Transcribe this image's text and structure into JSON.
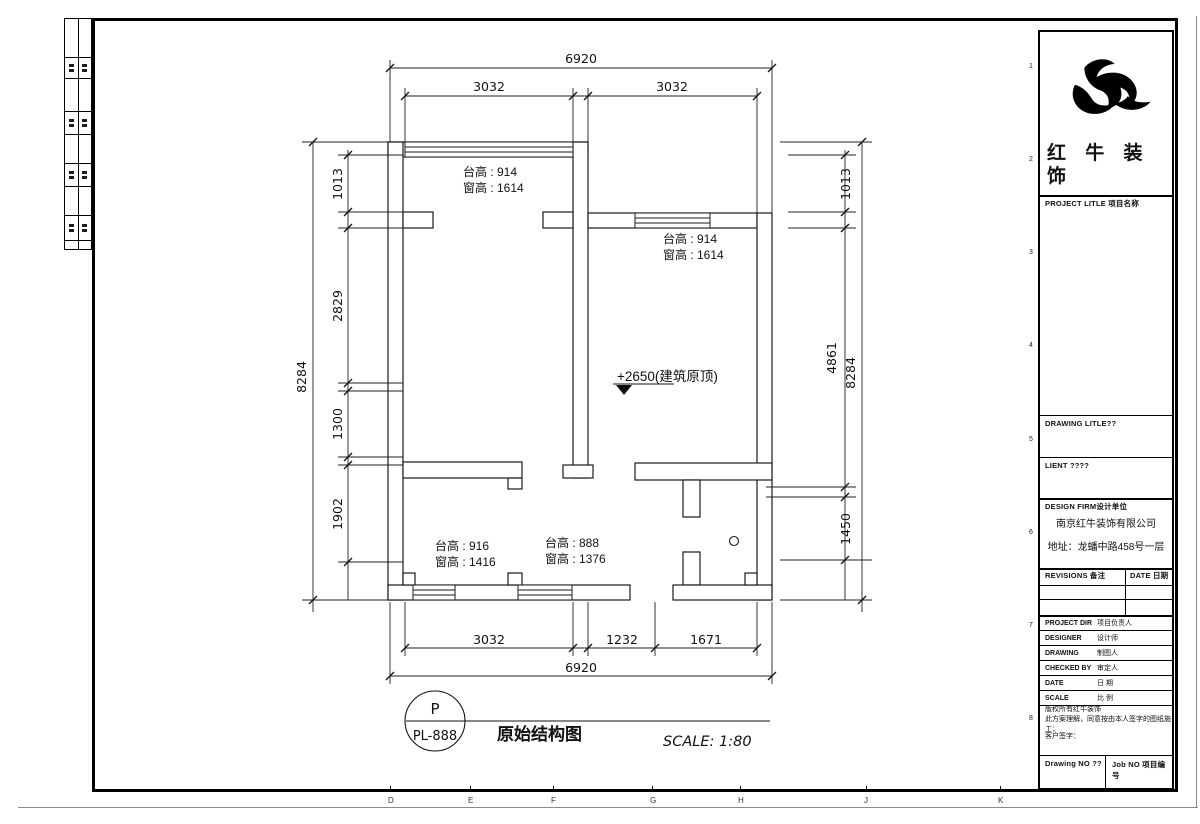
{
  "sheet": {
    "grid_letters": [
      "D",
      "E",
      "F",
      "G",
      "H",
      "J",
      "K"
    ],
    "grid_numbers": [
      "1",
      "2",
      "3",
      "4",
      "5",
      "6",
      "7",
      "8"
    ]
  },
  "title_block": {
    "logo_icon": "bull-logo",
    "company_name_line1": "红 牛 装",
    "company_name_line2": "饰",
    "project_title_label": "PROJECT LITLE 项目名称",
    "drawing_title_label": "DRAWING LITLE??",
    "client_label": "LIENT ????",
    "design_firm_label": "DESIGN FIRM设计单位",
    "design_firm_name": "南京红牛装饰有限公司",
    "design_firm_address": "地址：龙蟠中路458号一层",
    "revisions_label": "REVISIONS 备注",
    "revisions_date_label": "DATE 日期",
    "rows": [
      {
        "en": "PROJECT DIR",
        "cn": "项目负责人"
      },
      {
        "en": "DESIGNER",
        "cn": "设计师"
      },
      {
        "en": "DRAWING",
        "cn": "制图人"
      },
      {
        "en": "CHECKED BY",
        "cn": "审定人"
      },
      {
        "en": "DATE",
        "cn": "日 期"
      },
      {
        "en": "SCALE",
        "cn": "比 例"
      }
    ],
    "copyright_line1": "版权所有红牛装饰",
    "copyright_line2": "此方案理解，同意按由本人签字的图纸施工；",
    "customer_sign_label": "客户签字：",
    "drawing_no_label": "Drawing NO ??",
    "job_no_label": "Job NO 项目编号"
  },
  "plan": {
    "dims": {
      "top_overall": "6920",
      "top_left": "3032",
      "top_right": "3032",
      "left_overall": "8284",
      "left_chain": [
        "1013",
        "2829",
        "1300",
        "1902"
      ],
      "right_chain": [
        "1013",
        "4861",
        "1450"
      ],
      "right_overall": "8284",
      "bottom_chain": [
        "3032",
        "1232",
        "1671"
      ],
      "bottom_overall": "6920"
    },
    "annotations": [
      {
        "line1": "台高 : 914",
        "line2": "窗高 : 1614"
      },
      {
        "line1": "台高 : 914",
        "line2": "窗高 : 1614"
      },
      {
        "line1": "台高 : 916",
        "line2": "窗高 : 1416"
      },
      {
        "line1": "台高 : 888",
        "line2": "窗高 : 1376"
      }
    ],
    "elevation_note": "+2650(建筑原顶)"
  },
  "footer": {
    "bubble_top": "P",
    "bubble_bottom": "PL-888",
    "drawing_title": "原始结构图",
    "scale_text": "SCALE: 1:80"
  }
}
